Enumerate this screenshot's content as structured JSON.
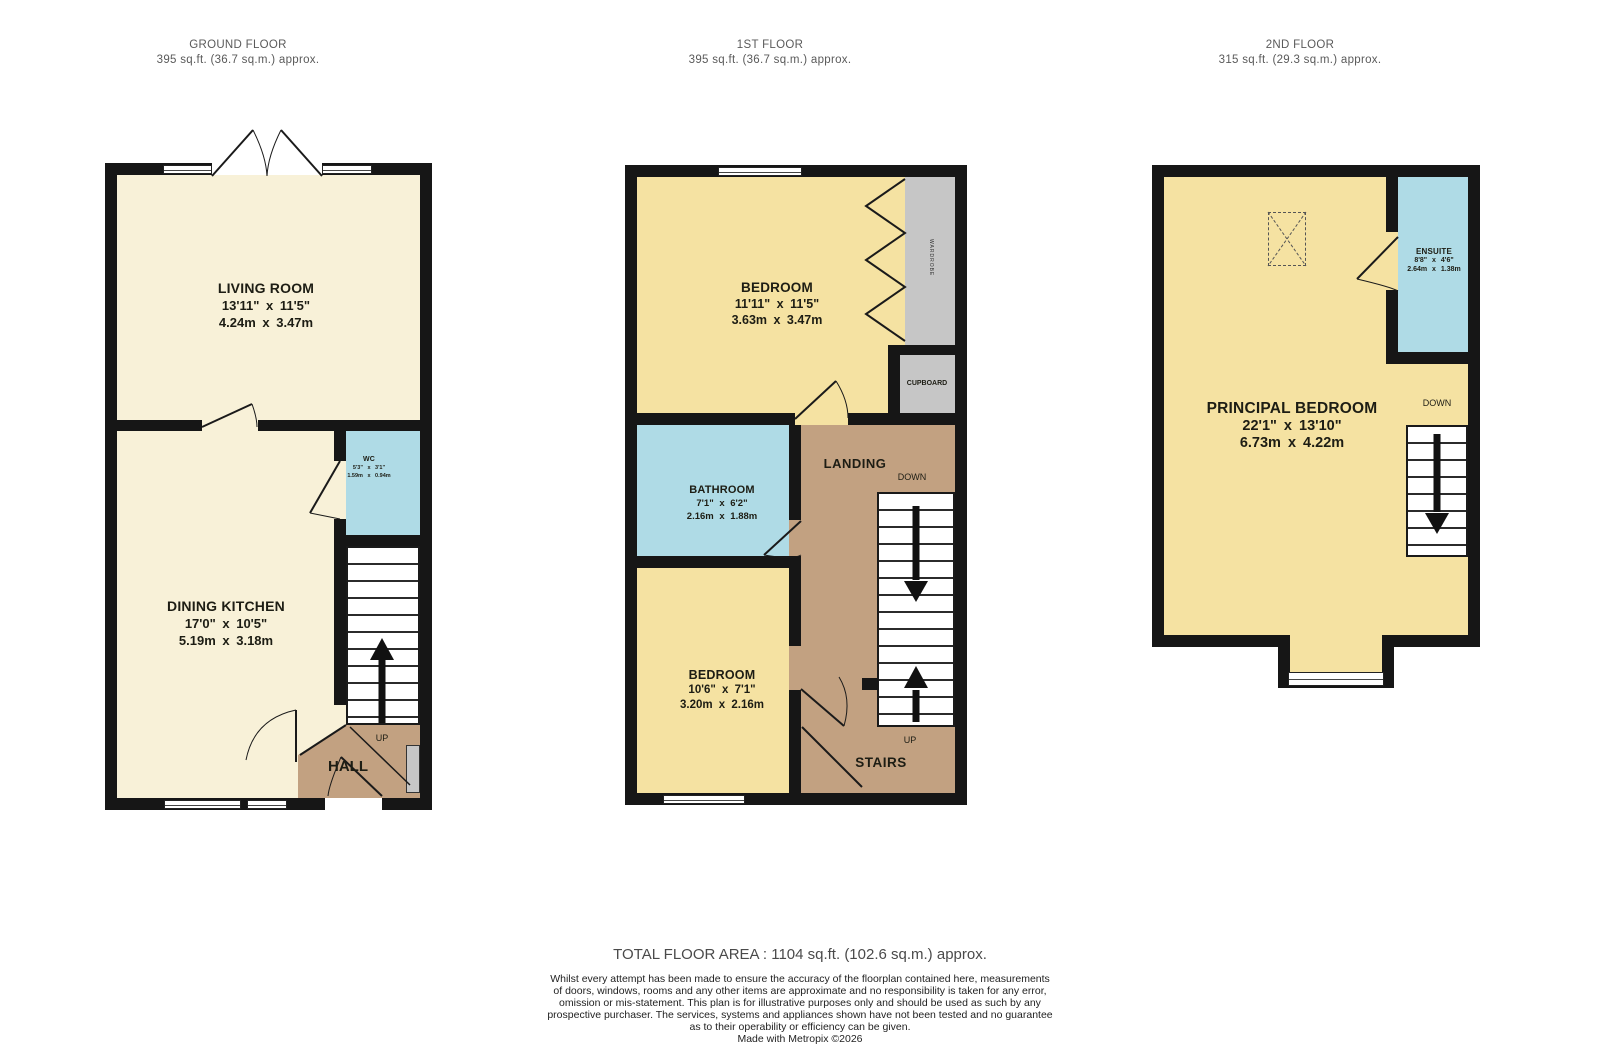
{
  "floors": [
    {
      "title": "GROUND FLOOR",
      "area": "395 sq.ft. (36.7 sq.m.) approx.",
      "rooms": {
        "living": {
          "name": "LIVING ROOM",
          "imperial": "13'11\" x 11'5\"",
          "metric": "4.24m x 3.47m"
        },
        "wc": {
          "name": "WC",
          "imperial": "5'3\" x 3'1\"",
          "metric": "1.59m x 0.94m"
        },
        "dining": {
          "name": "DINING KITCHEN",
          "imperial": "17'0\" x 10'5\"",
          "metric": "5.19m x 3.18m"
        },
        "hall": {
          "name": "HALL"
        }
      },
      "labels": {
        "up": "UP"
      }
    },
    {
      "title": "1ST FLOOR",
      "area": "395 sq.ft. (36.7 sq.m.) approx.",
      "rooms": {
        "bedroom1": {
          "name": "BEDROOM",
          "imperial": "11'11\" x 11'5\"",
          "metric": "3.63m x 3.47m"
        },
        "bathroom": {
          "name": "BATHROOM",
          "imperial": "7'1\" x 6'2\"",
          "metric": "2.16m x 1.88m"
        },
        "bedroom2": {
          "name": "BEDROOM",
          "imperial": "10'6\" x 7'1\"",
          "metric": "3.20m x 2.16m"
        },
        "landing": {
          "name": "LANDING"
        },
        "cupboard": {
          "name": "CUPBOARD"
        },
        "wardrobe": {
          "name": "WARDROBE"
        },
        "stairs": {
          "name": "STAIRS"
        }
      },
      "labels": {
        "up": "UP",
        "down": "DOWN"
      }
    },
    {
      "title": "2ND FLOOR",
      "area": "315 sq.ft. (29.3 sq.m.) approx.",
      "rooms": {
        "principal": {
          "name": "PRINCIPAL BEDROOM",
          "imperial": "22'1\" x 13'10\"",
          "metric": "6.73m x 4.22m"
        },
        "ensuite": {
          "name": "ENSUITE",
          "imperial": "8'8\" x 4'6\"",
          "metric": "2.64m x 1.38m"
        }
      },
      "labels": {
        "down": "DOWN"
      }
    }
  ],
  "footer": {
    "total": "TOTAL FLOOR AREA : 1104 sq.ft. (102.6 sq.m.) approx.",
    "disclaimer_lines": [
      "Whilst every attempt has been made to ensure the accuracy of the floorplan contained here, measurements",
      "of doors, windows, rooms and any other items are approximate and no responsibility is taken for any error,",
      "omission or mis-statement. This plan is for illustrative purposes only and should be used as such by any",
      "prospective purchaser. The services, systems and appliances shown have not been tested and no guarantee",
      "as to their operability or efficiency can be given."
    ],
    "credit": "Made with Metropix ©2026"
  },
  "colors": {
    "wall": "#161616",
    "cream": "#F8F1D8",
    "yellow": "#F5E2A2",
    "blue": "#AFDBE6",
    "tan": "#C2A181",
    "gray": "#C6C6C6"
  }
}
